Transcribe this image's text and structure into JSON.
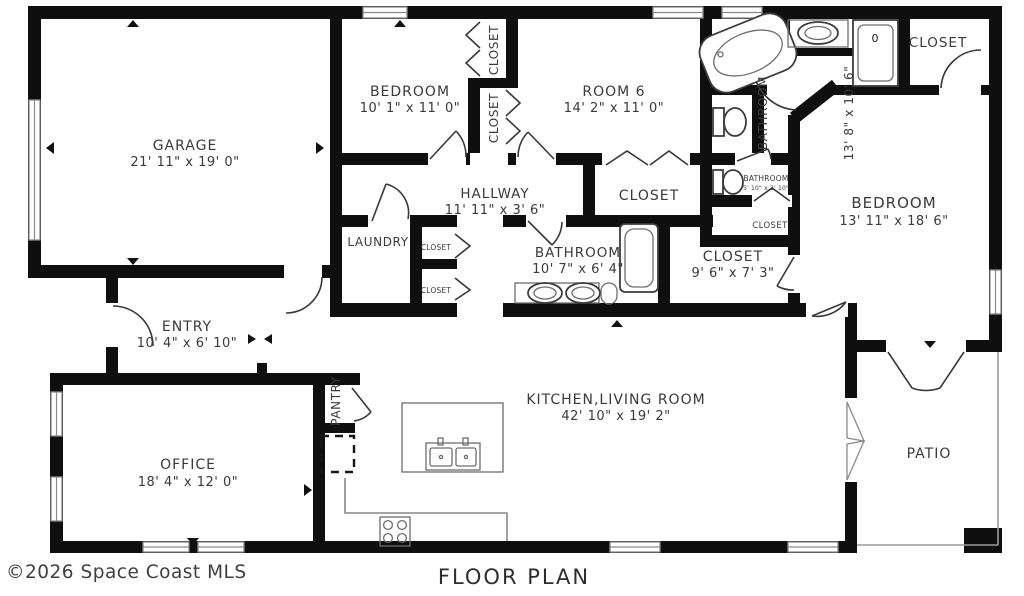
{
  "meta": {
    "title": "FLOOR PLAN",
    "copyright": "©2026 Space Coast MLS",
    "colors": {
      "wall": "#0f0f0f",
      "text": "#3a3a3a",
      "background": "#ffffff",
      "fixture_line": "#6d6d6d"
    }
  },
  "rooms": {
    "garage": {
      "name": "GARAGE",
      "dims": "21' 11\" x 19' 0\""
    },
    "bedroom2": {
      "name": "BEDROOM",
      "dims": "10' 1\" x 11' 0\""
    },
    "room6": {
      "name": "ROOM 6",
      "dims": "14' 2\" x 11' 0\""
    },
    "hallway": {
      "name": "HALLWAY",
      "dims": "11' 11\" x 3' 6\""
    },
    "hall_closet": {
      "name": "CLOSET"
    },
    "closet_strip_top": {
      "name": "CLOSET"
    },
    "closet_strip_bot": {
      "name": "CLOSET"
    },
    "laundry": {
      "name": "LAUNDRY"
    },
    "closet_a": {
      "name": "CLOSET"
    },
    "closet_b": {
      "name": "CLOSET"
    },
    "bathroom2": {
      "name": "BATHROOM",
      "dims": "10' 7\" x 6' 4\""
    },
    "walkin_closet": {
      "name": "CLOSET",
      "dims": "9' 6\" x 7' 3\""
    },
    "closet_linen": {
      "name": "CLOSET"
    },
    "bathroom_small": {
      "name": "BATHROOM",
      "dims": "5' 10\" x 2' 10\""
    },
    "bathroom_master": {
      "name": "BATHROOM",
      "dims": "13' 8\" x 10' 6\""
    },
    "closet_tr": {
      "name": "CLOSET"
    },
    "bedroom_master": {
      "name": "BEDROOM",
      "dims": "13' 11\" x 18' 6\""
    },
    "entry": {
      "name": "ENTRY",
      "dims": "10' 4\" x 6' 10\""
    },
    "pantry": {
      "name": "PANTRY"
    },
    "office": {
      "name": "OFFICE",
      "dims": "18' 4\" x 12' 0\""
    },
    "kitchen_living": {
      "name": "KITCHEN,LIVING ROOM",
      "dims": "42' 10\" x 19' 2\""
    },
    "patio": {
      "name": "PATIO"
    }
  },
  "fixtures": {
    "shower_label": "0"
  }
}
